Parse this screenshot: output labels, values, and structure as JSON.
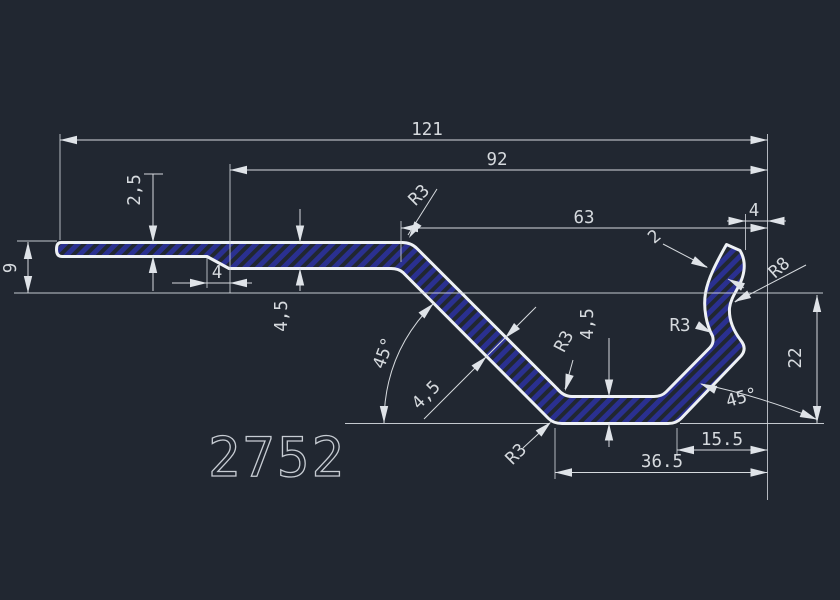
{
  "app": {
    "type": "cad-drawing-view"
  },
  "drawing": {
    "part_number": "2752",
    "colors": {
      "background": "#212731",
      "outline": "#eef1f4",
      "dimension_lines": "#d6dade",
      "hatch": "#2a3090"
    },
    "dims": {
      "len121": "121",
      "len92": "92",
      "len63": "63",
      "len4_hook": "4",
      "thk2_5": "2,5",
      "h9": "9",
      "len4_step": "4",
      "thk4_5_left": "4,5",
      "ang45_left": "45°",
      "thk4_5_diag": "4,5",
      "r3_top": "R3",
      "r3_mid": "R3",
      "r3_bottom": "R3",
      "r3_hook": "R3",
      "thk4_5_bottom": "4,5",
      "thk2_tip": "2",
      "r8_hook": "R8",
      "ang45_right": "45°",
      "h22": "22",
      "len15_5": "15.5",
      "len36_5": "36.5"
    }
  }
}
